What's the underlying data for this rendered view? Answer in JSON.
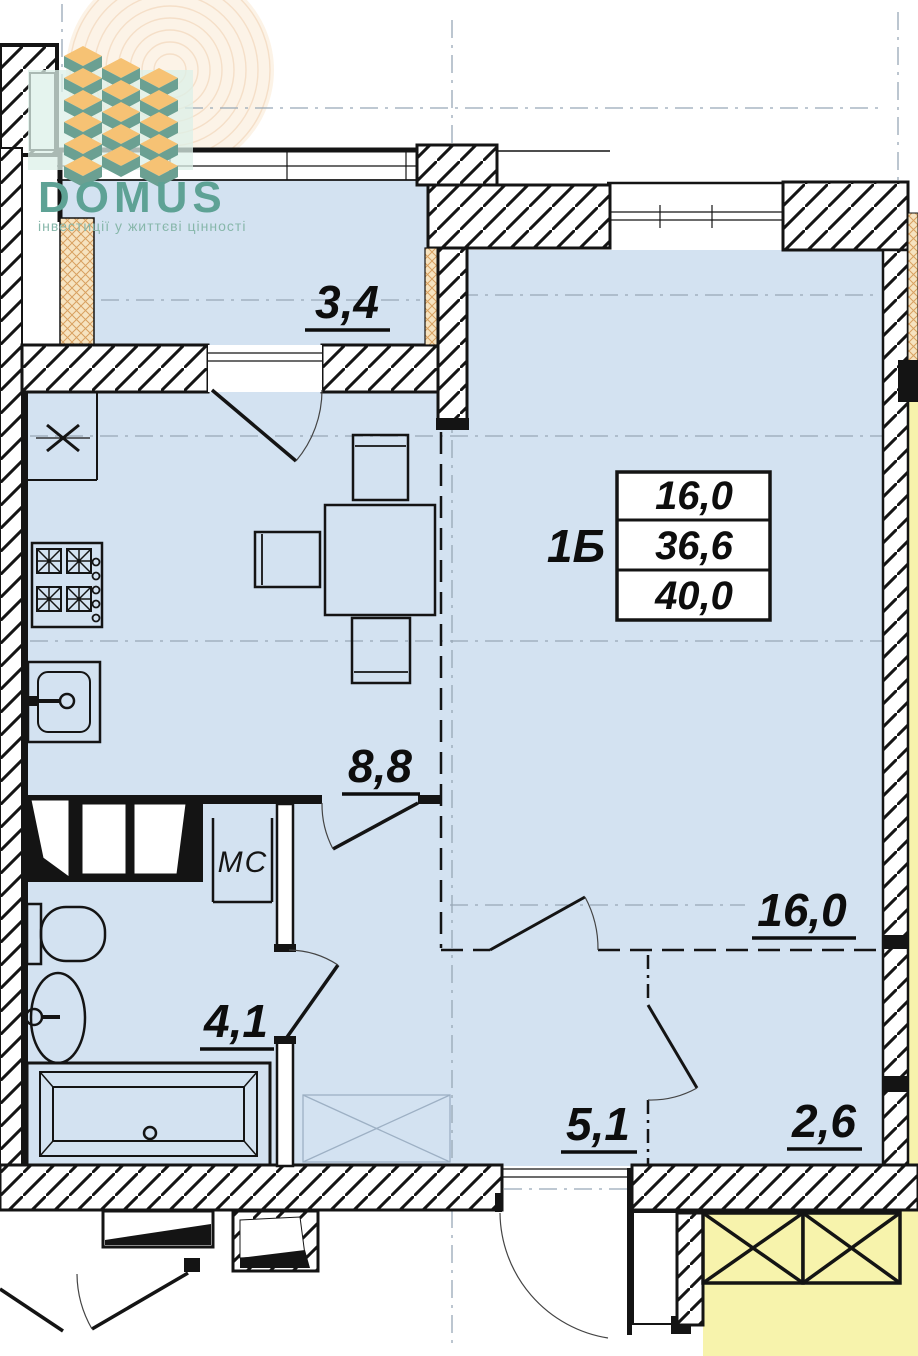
{
  "logo": {
    "brand": "DOMUS",
    "tagline": "інвестиції у життєві цінності",
    "brand_color": "#5ea295",
    "tagline_color": "#87b7aa"
  },
  "plan": {
    "unit_label": "1Б",
    "info_table": {
      "rows": [
        {
          "value": "16,0"
        },
        {
          "value": "36,6"
        },
        {
          "value": "40,0"
        }
      ]
    },
    "rooms": [
      {
        "name": "balcony",
        "area": "3,4"
      },
      {
        "name": "kitchen",
        "area": "8,8"
      },
      {
        "name": "living-room",
        "area": "16,0"
      },
      {
        "name": "bathroom",
        "area": "4,1"
      },
      {
        "name": "hallway",
        "area": "5,1"
      },
      {
        "name": "loggia",
        "area": "2,6"
      }
    ],
    "labels": {
      "washing_machine": "МС"
    },
    "colors": {
      "room_fill": "#d3e2f1",
      "neighbor_fill": "#f7f3ac",
      "insulation_fill": "#f6e3c0",
      "line": "#141414",
      "axis": "#97a7b6"
    }
  }
}
